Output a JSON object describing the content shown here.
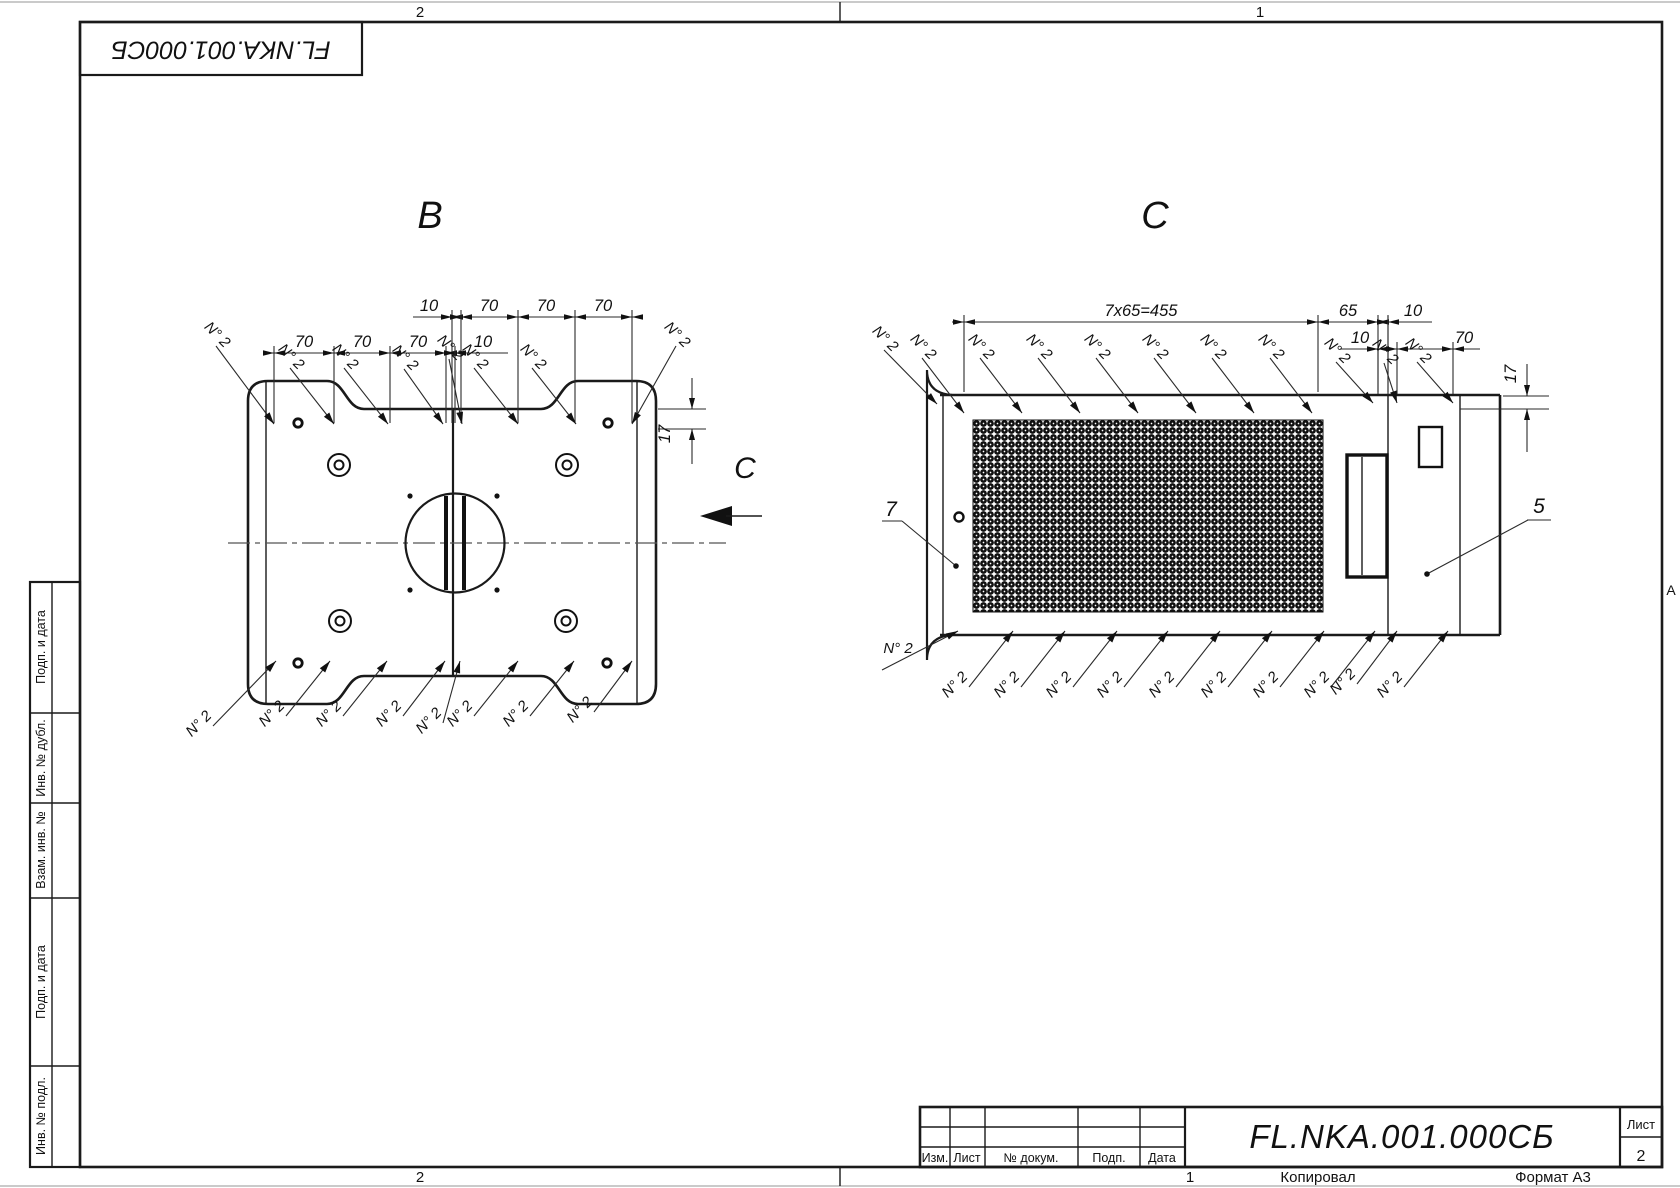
{
  "corner_designation": "FL.NKA.001.000СБ",
  "stamp": {
    "designation": "FL.NKA.001.000СБ",
    "sheet_label": "Лист",
    "sheet_number": "2",
    "columns": [
      "Изм.",
      "Лист",
      "№ докум.",
      "Подп.",
      "Дата"
    ],
    "copied_note": "Копировал",
    "format_note": "Формат А3"
  },
  "margins": {
    "zone_top_left": "2",
    "zone_top_right": "1",
    "zone_bottom_left": "2",
    "zone_bottom_right": "1",
    "row_marker": "A",
    "side_column": [
      "Подп. и дата",
      "Инв. № дубл.",
      "Взам. инв. №",
      "Подп. и дата",
      "Инв. № подл."
    ]
  },
  "view_b": {
    "title": "B",
    "weld_label": "N° 2",
    "dims_upper": [
      "10",
      "70",
      "70",
      "70"
    ],
    "dims_lower": [
      "70",
      "70",
      "70",
      "10"
    ],
    "offset_dim": "17"
  },
  "view_c": {
    "title": "C",
    "direction_label": "C",
    "weld_label": "N° 2",
    "dims_row1": [
      "7x65=455",
      "65",
      "10"
    ],
    "dims_row2": [
      "10",
      "70"
    ],
    "offset_dim": "17",
    "item_mesh": "7",
    "item_panel": "5"
  }
}
